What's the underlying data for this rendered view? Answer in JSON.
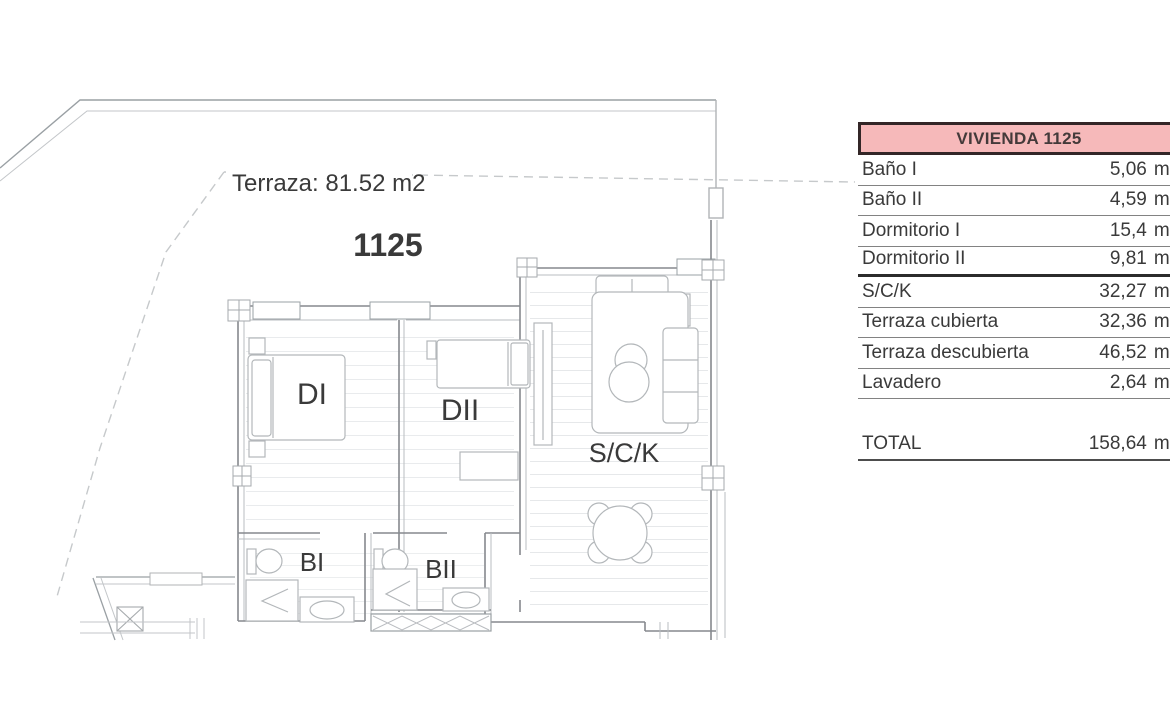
{
  "floor_plan": {
    "terrace_label": "Terraza: 81.52 m2",
    "unit_number": "1125",
    "unit_number_color": "#c23a31",
    "room_labels": {
      "dormitorio1": "DI",
      "dormitorio2": "DII",
      "salon_cocina": "S/C/K",
      "bano1": "BI",
      "bano2": "BII"
    }
  },
  "area_table": {
    "title": "VIVIENDA 1125",
    "header_bg": "#f6b9ba",
    "header_border": "#332627",
    "unit_suffix": "m²",
    "rows": [
      {
        "label": "Baño I",
        "value": "5,06"
      },
      {
        "label": "Baño II",
        "value": "4,59"
      },
      {
        "label": "Dormitorio I",
        "value": "15,4"
      },
      {
        "label": "Dormitorio II",
        "value": "9,81"
      },
      {
        "label": "S/C/K",
        "value": "32,27"
      },
      {
        "label": "Terraza cubierta",
        "value": "32,36"
      },
      {
        "label": "Terraza descubierta",
        "value": "46,52"
      },
      {
        "label": "Lavadero",
        "value": "2,64"
      }
    ],
    "total": {
      "label": "TOTAL",
      "value": "158,64"
    }
  }
}
